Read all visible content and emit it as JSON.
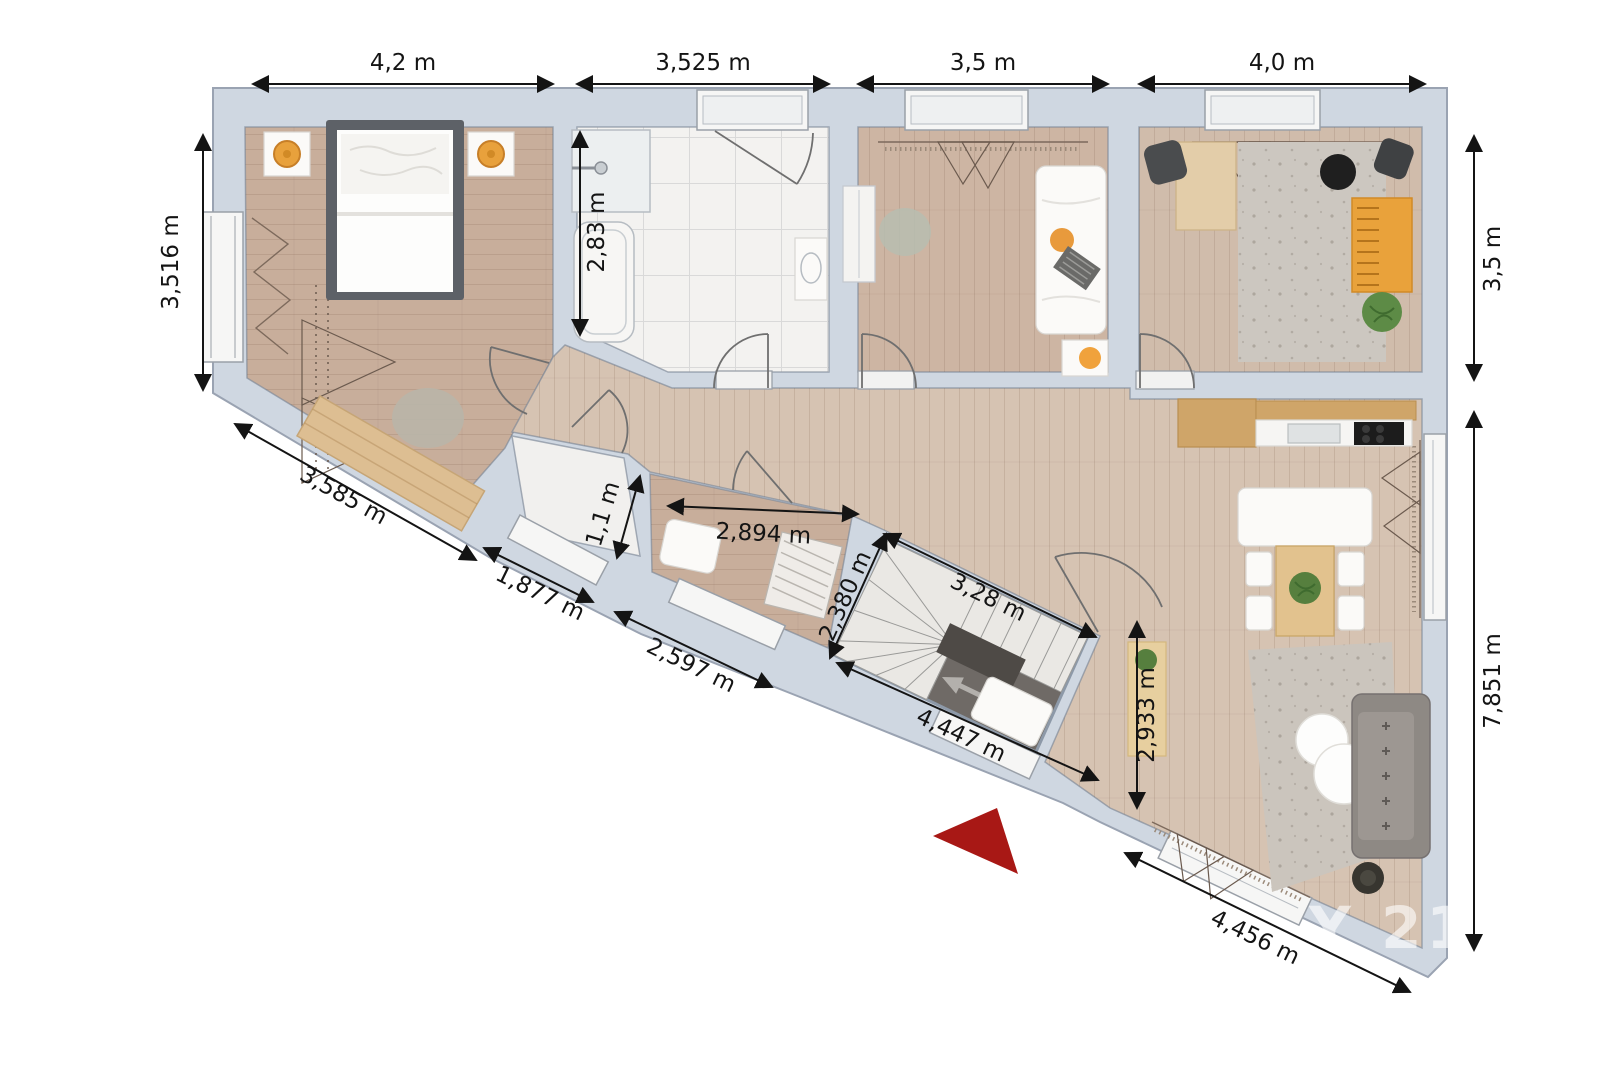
{
  "floorplan": {
    "watermark": "CENTURY 21",
    "unit": "m",
    "dimensions": {
      "top_bedroom": "4,2 m",
      "top_bathroom": "3,525 m",
      "top_room3": "3,5 m",
      "top_room4": "4,0 m",
      "left_bedroom": "3,516 m",
      "right_room4": "3,5 m",
      "right_living": "7,851 m",
      "bathroom_depth": "2,83 m",
      "wc_width": "1,1 m",
      "small_room_width": "2,894 m",
      "stair_side": "2,380 m",
      "stair_top": "3,28 m",
      "stair_bottom": "4,447 m",
      "living_left": "2,933 m",
      "diag_bedroom_wall": "3,585 m",
      "diag_wc_wall": "1,877 m",
      "diag_small_room_wall": "2,597 m",
      "diag_living_wall": "4,456 m"
    },
    "colors": {
      "wall": "#cfd7e1",
      "wood_floor": "#cdb5a3",
      "hall_floor": "#d6c3b2",
      "bathroom_floor": "#f3f2f0",
      "stair_floor": "#6f6a66",
      "entrance_arrow": "#a81815",
      "dimension_text": "#141414"
    }
  }
}
